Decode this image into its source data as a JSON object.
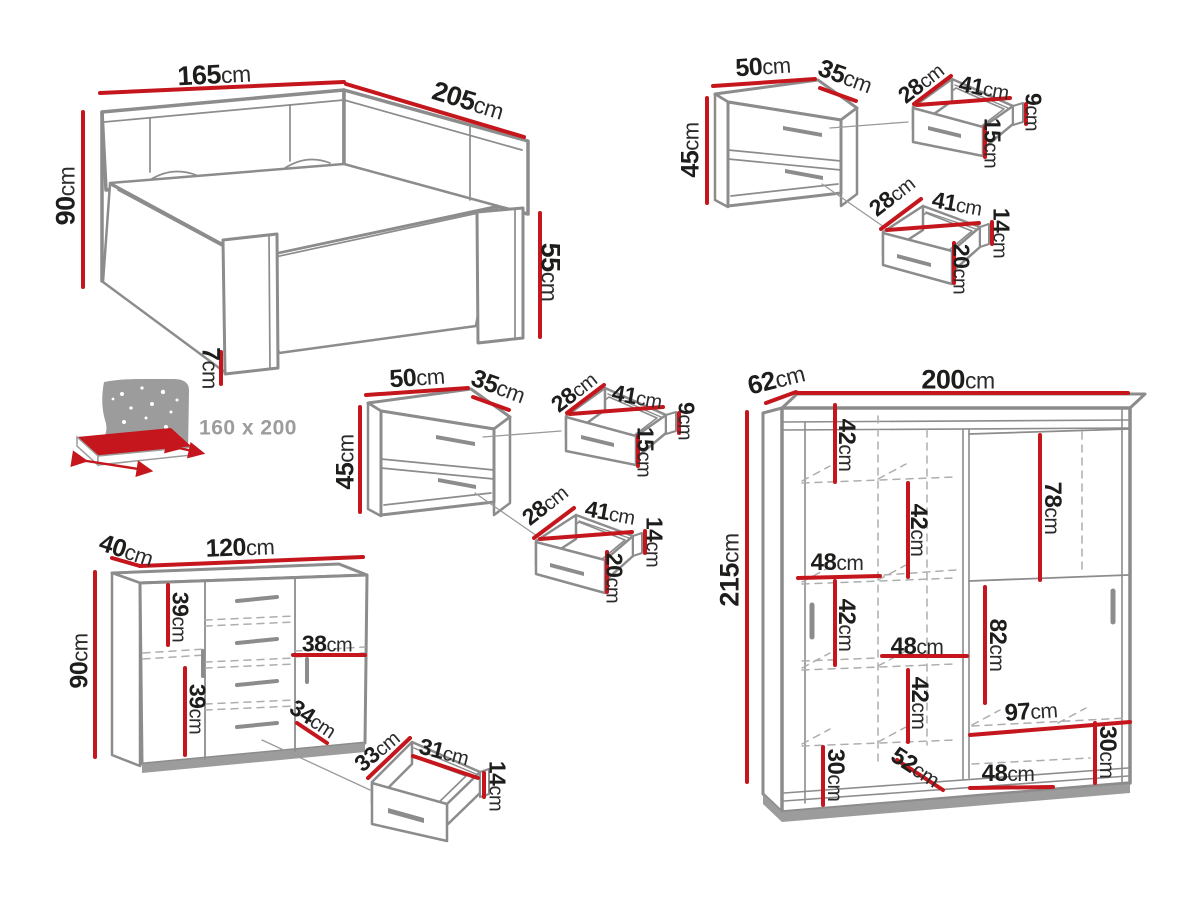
{
  "meta": {
    "title": "Bedroom furniture set dimension diagram"
  },
  "colors": {
    "dimension_red": "#c4161c",
    "furniture_gray": "#8c8c8c",
    "dashed_gray": "#aeaeae",
    "text_dark": "#1d1d1b",
    "muted_gray": "#9c9c9c",
    "background": "#ffffff"
  },
  "mattress_label": {
    "text": "160 x 200",
    "x": 248,
    "y": 428,
    "size": 21
  },
  "pieces": {
    "bed": {
      "width": "165cm",
      "depth": "205cm",
      "headboard_height": "90cm",
      "footboard_height": "55cm",
      "leg_height": "7cm",
      "mattress_size": "160 x 200"
    },
    "nightstand_right": {
      "width": "50cm",
      "depth": "35cm",
      "height": "45cm",
      "top_drawer": [
        "28cm",
        "41cm",
        "9cm",
        "15cm"
      ],
      "bottom_drawer": [
        "28cm",
        "41cm",
        "14cm",
        "20cm"
      ]
    },
    "nightstand_left": {
      "width": "50cm",
      "depth": "35cm",
      "height": "45cm",
      "top_drawer": [
        "28cm",
        "41cm",
        "9cm",
        "15cm"
      ],
      "bottom_drawer": [
        "28cm",
        "41cm",
        "14cm",
        "20cm"
      ]
    },
    "chest": {
      "depth": "40cm",
      "width": "120cm",
      "height": "90cm",
      "interior": [
        "39cm",
        "39cm",
        "38cm",
        "34cm"
      ],
      "drawer": [
        "33cm",
        "31cm",
        "14cm"
      ]
    },
    "wardrobe": {
      "depth": "62cm",
      "width": "200cm",
      "height": "215cm",
      "interior": [
        "42cm",
        "42cm",
        "48cm",
        "42cm",
        "48cm",
        "42cm",
        "78cm",
        "82cm",
        "97cm",
        "30cm",
        "52cm",
        "48cm",
        "30cm"
      ]
    }
  },
  "labels": [
    {
      "v": "165",
      "u": "cm",
      "x": 214,
      "y": 75,
      "r": -3,
      "s": 27
    },
    {
      "v": "205",
      "u": "cm",
      "x": 468,
      "y": 101,
      "r": 17,
      "s": 27
    },
    {
      "v": "90",
      "u": "cm",
      "x": 66,
      "y": 196,
      "r": -90,
      "s": 27
    },
    {
      "v": "55",
      "u": "cm",
      "x": 550,
      "y": 272,
      "r": 90,
      "s": 27
    },
    {
      "v": "7",
      "u": "cm",
      "x": 210,
      "y": 368,
      "r": 90,
      "s": 25
    },
    {
      "v": "50",
      "u": "cm",
      "x": 763,
      "y": 67,
      "r": -4,
      "s": 25
    },
    {
      "v": "35",
      "u": "cm",
      "x": 845,
      "y": 77,
      "r": 20,
      "s": 25
    },
    {
      "v": "45",
      "u": "cm",
      "x": 691,
      "y": 150,
      "r": -90,
      "s": 25
    },
    {
      "v": "28",
      "u": "cm",
      "x": 921,
      "y": 83,
      "r": -38,
      "s": 23
    },
    {
      "v": "41",
      "u": "cm",
      "x": 984,
      "y": 88,
      "r": 10,
      "s": 23
    },
    {
      "v": "9",
      "u": "cm",
      "x": 1033,
      "y": 112,
      "r": 90,
      "s": 23
    },
    {
      "v": "15",
      "u": "cm",
      "x": 992,
      "y": 143,
      "r": 90,
      "s": 23
    },
    {
      "v": "28",
      "u": "cm",
      "x": 892,
      "y": 196,
      "r": -38,
      "s": 23
    },
    {
      "v": "41",
      "u": "cm",
      "x": 957,
      "y": 204,
      "r": 10,
      "s": 23
    },
    {
      "v": "14",
      "u": "cm",
      "x": 1001,
      "y": 233,
      "r": 90,
      "s": 23
    },
    {
      "v": "20",
      "u": "cm",
      "x": 961,
      "y": 269,
      "r": 90,
      "s": 23
    },
    {
      "v": "50",
      "u": "cm",
      "x": 417,
      "y": 378,
      "r": -4,
      "s": 25
    },
    {
      "v": "35",
      "u": "cm",
      "x": 498,
      "y": 387,
      "r": 20,
      "s": 25
    },
    {
      "v": "45",
      "u": "cm",
      "x": 346,
      "y": 462,
      "r": -90,
      "s": 25
    },
    {
      "v": "28",
      "u": "cm",
      "x": 574,
      "y": 392,
      "r": -38,
      "s": 23
    },
    {
      "v": "41",
      "u": "cm",
      "x": 637,
      "y": 397,
      "r": 10,
      "s": 23
    },
    {
      "v": "9",
      "u": "cm",
      "x": 686,
      "y": 421,
      "r": 90,
      "s": 23
    },
    {
      "v": "15",
      "u": "cm",
      "x": 645,
      "y": 452,
      "r": 90,
      "s": 23
    },
    {
      "v": "28",
      "u": "cm",
      "x": 545,
      "y": 505,
      "r": -38,
      "s": 23
    },
    {
      "v": "41",
      "u": "cm",
      "x": 610,
      "y": 513,
      "r": 10,
      "s": 23
    },
    {
      "v": "14",
      "u": "cm",
      "x": 654,
      "y": 542,
      "r": 90,
      "s": 23
    },
    {
      "v": "20",
      "u": "cm",
      "x": 614,
      "y": 578,
      "r": 90,
      "s": 23
    },
    {
      "v": "40",
      "u": "cm",
      "x": 126,
      "y": 551,
      "r": 18,
      "s": 25
    },
    {
      "v": "120",
      "u": "cm",
      "x": 240,
      "y": 548,
      "r": -2,
      "s": 25
    },
    {
      "v": "90",
      "u": "cm",
      "x": 80,
      "y": 661,
      "r": -90,
      "s": 25
    },
    {
      "v": "39",
      "u": "cm",
      "x": 180,
      "y": 617,
      "r": 90,
      "s": 23
    },
    {
      "v": "39",
      "u": "cm",
      "x": 197,
      "y": 709,
      "r": 90,
      "s": 23
    },
    {
      "v": "38",
      "u": "cm",
      "x": 327,
      "y": 644,
      "r": 0,
      "s": 23
    },
    {
      "v": "34",
      "u": "cm",
      "x": 313,
      "y": 719,
      "r": 33,
      "s": 23
    },
    {
      "v": "33",
      "u": "cm",
      "x": 377,
      "y": 751,
      "r": -40,
      "s": 23
    },
    {
      "v": "31",
      "u": "cm",
      "x": 444,
      "y": 752,
      "r": 14,
      "s": 23
    },
    {
      "v": "14",
      "u": "cm",
      "x": 497,
      "y": 786,
      "r": 90,
      "s": 23
    },
    {
      "v": "62",
      "u": "cm",
      "x": 776,
      "y": 379,
      "r": -14,
      "s": 26
    },
    {
      "v": "200",
      "u": "cm",
      "x": 958,
      "y": 380,
      "r": 0,
      "s": 27
    },
    {
      "v": "215",
      "u": "cm",
      "x": 730,
      "y": 570,
      "r": -90,
      "s": 27
    },
    {
      "v": "42",
      "u": "cm",
      "x": 846,
      "y": 445,
      "r": 90,
      "s": 24
    },
    {
      "v": "42",
      "u": "cm",
      "x": 918,
      "y": 530,
      "r": 90,
      "s": 24
    },
    {
      "v": "48",
      "u": "cm",
      "x": 837,
      "y": 563,
      "r": 0,
      "s": 24
    },
    {
      "v": "42",
      "u": "cm",
      "x": 846,
      "y": 625,
      "r": 90,
      "s": 24
    },
    {
      "v": "48",
      "u": "cm",
      "x": 917,
      "y": 647,
      "r": 0,
      "s": 24
    },
    {
      "v": "42",
      "u": "cm",
      "x": 919,
      "y": 703,
      "r": 90,
      "s": 24
    },
    {
      "v": "78",
      "u": "cm",
      "x": 1052,
      "y": 508,
      "r": 90,
      "s": 24
    },
    {
      "v": "82",
      "u": "cm",
      "x": 997,
      "y": 645,
      "r": 90,
      "s": 24
    },
    {
      "v": "97",
      "u": "cm",
      "x": 1031,
      "y": 712,
      "r": -4,
      "s": 24
    },
    {
      "v": "30",
      "u": "cm",
      "x": 1107,
      "y": 752,
      "r": 90,
      "s": 24
    },
    {
      "v": "30",
      "u": "cm",
      "x": 835,
      "y": 775,
      "r": 90,
      "s": 24
    },
    {
      "v": "52",
      "u": "cm",
      "x": 915,
      "y": 768,
      "r": 33,
      "s": 24
    },
    {
      "v": "48",
      "u": "cm",
      "x": 1008,
      "y": 774,
      "r": 0,
      "s": 24
    }
  ]
}
